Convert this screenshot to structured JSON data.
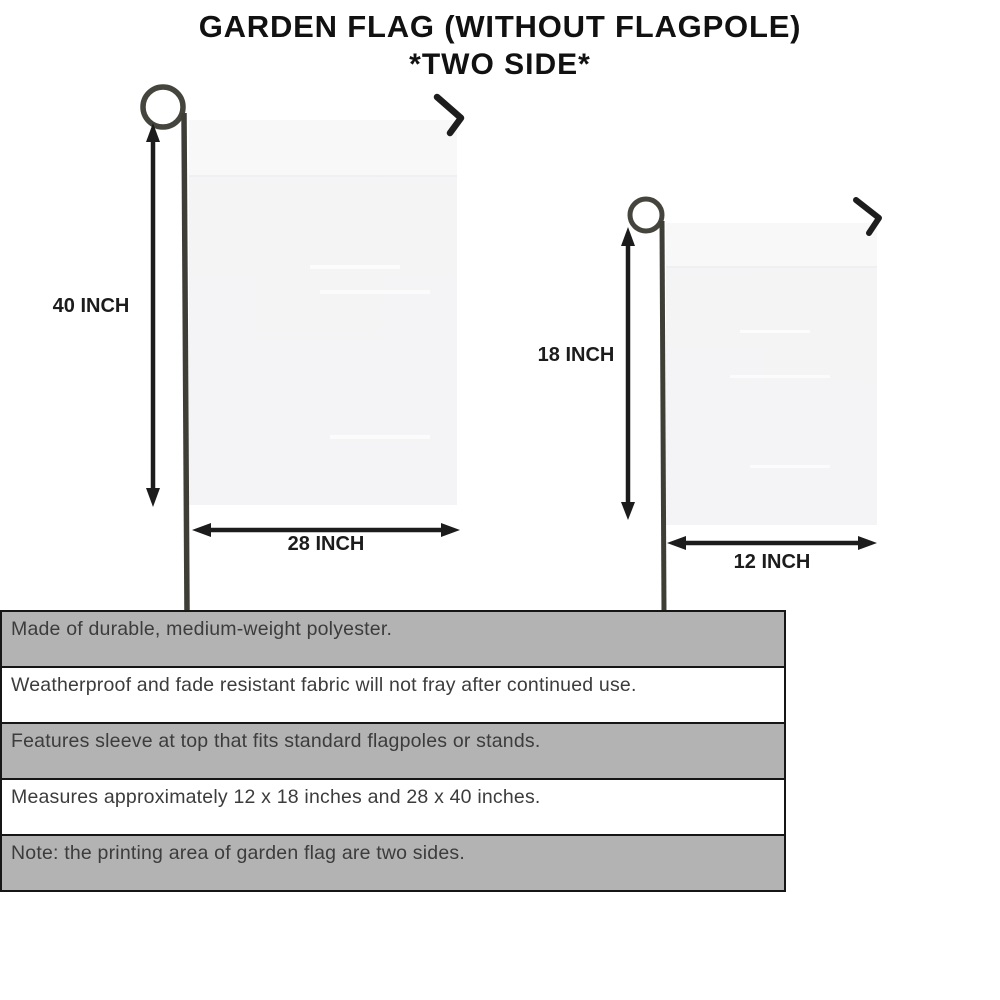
{
  "header": {
    "title_line1": "GARDEN FLAG (WITHOUT FLAGPOLE)",
    "title_line2": "*TWO SIDE*"
  },
  "diagram": {
    "large_flag": {
      "height_label": "40 INCH",
      "width_label": "28 INCH"
    },
    "small_flag": {
      "height_label": "18 INCH",
      "width_label": "12 INCH"
    }
  },
  "features": {
    "rows": [
      {
        "text": "Made of durable, medium-weight polyester.",
        "shaded": true
      },
      {
        "text": "Weatherproof and fade resistant fabric will not fray after continued use.",
        "shaded": false
      },
      {
        "text": "Features sleeve at top that fits standard flagpoles or stands.",
        "shaded": true
      },
      {
        "text": "Measures approximately 12 x 18 inches and 28 x 40 inches.",
        "shaded": false
      },
      {
        "text": "Note: the printing area of garden flag are two sides.",
        "shaded": true
      }
    ]
  },
  "colors": {
    "row_shaded": "#b3b3b3",
    "row_plain": "#ffffff",
    "row_border": "#161616",
    "flag_fill": "#f5f5f6",
    "pole": "#40403a",
    "arrow": "#1c1c1c",
    "title_text": "#111111",
    "feature_text": "#3c3c3c"
  }
}
